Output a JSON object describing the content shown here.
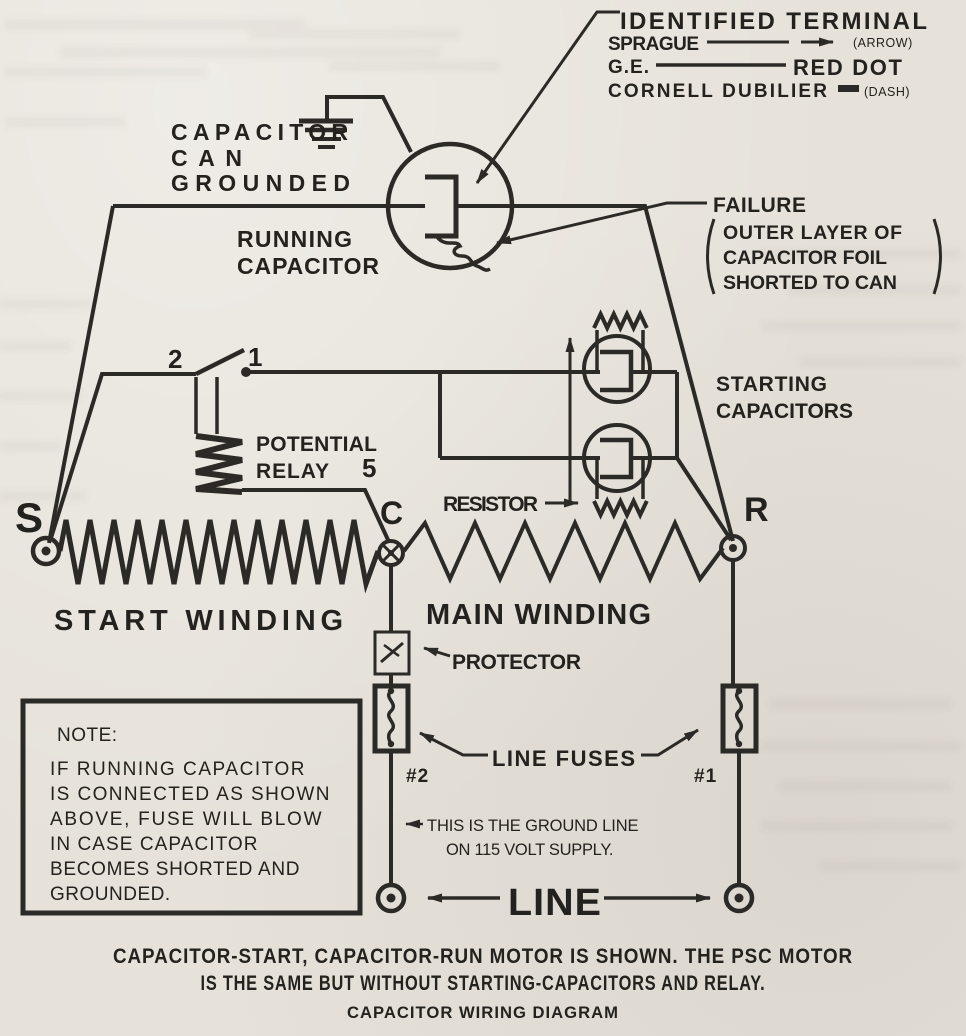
{
  "legend": {
    "title": "IDENTIFIED TERMINAL",
    "rows": [
      {
        "brand": "SPRAGUE",
        "mark": "(ARROW)"
      },
      {
        "brand": "G.E.",
        "mark": "RED DOT"
      },
      {
        "brand": "CORNELL DUBILIER",
        "mark": "(DASH)"
      }
    ]
  },
  "labels": {
    "capacitor_can_grounded": {
      "line1": "CAPACITOR",
      "line2": "CAN",
      "line3": "GROUNDED"
    },
    "running_capacitor": {
      "line1": "RUNNING",
      "line2": "CAPACITOR"
    },
    "failure": {
      "title": "FAILURE",
      "line1": "OUTER LAYER OF",
      "line2": "CAPACITOR FOIL",
      "line3": "SHORTED TO CAN"
    },
    "starting_capacitors": {
      "line1": "STARTING",
      "line2": "CAPACITORS"
    },
    "resistor": "RESISTOR",
    "potential_relay": {
      "line1": "POTENTIAL",
      "line2": "RELAY"
    },
    "protector": "PROTECTOR",
    "line_fuses": "LINE FUSES",
    "start_winding": "START WINDING",
    "main_winding": "MAIN WINDING",
    "ground_note": {
      "line1": "THIS IS THE GROUND LINE",
      "line2": "ON 115 VOLT SUPPLY."
    },
    "line": "LINE"
  },
  "terminals": {
    "s": "S",
    "c": "C",
    "r": "R"
  },
  "relay": {
    "contact_2": "2",
    "contact_1": "1",
    "terminal_5": "5"
  },
  "fuses": {
    "fuse_1": "#1",
    "fuse_2": "#2"
  },
  "note_box": {
    "heading": "NOTE:",
    "lines": [
      "IF RUNNING CAPACITOR",
      "IS CONNECTED AS SHOWN",
      "ABOVE, FUSE WILL BLOW",
      "IN CASE CAPACITOR",
      "BECOMES SHORTED AND",
      "GROUNDED."
    ]
  },
  "caption": {
    "line1": "CAPACITOR-START, CAPACITOR-RUN MOTOR IS SHOWN. THE PSC MOTOR",
    "line2": "IS THE SAME BUT WITHOUT STARTING-CAPACITORS AND RELAY.",
    "title": "CAPACITOR WIRING DIAGRAM"
  },
  "colors": {
    "ink": "#2c2a26",
    "paper": "#e6e2da"
  }
}
